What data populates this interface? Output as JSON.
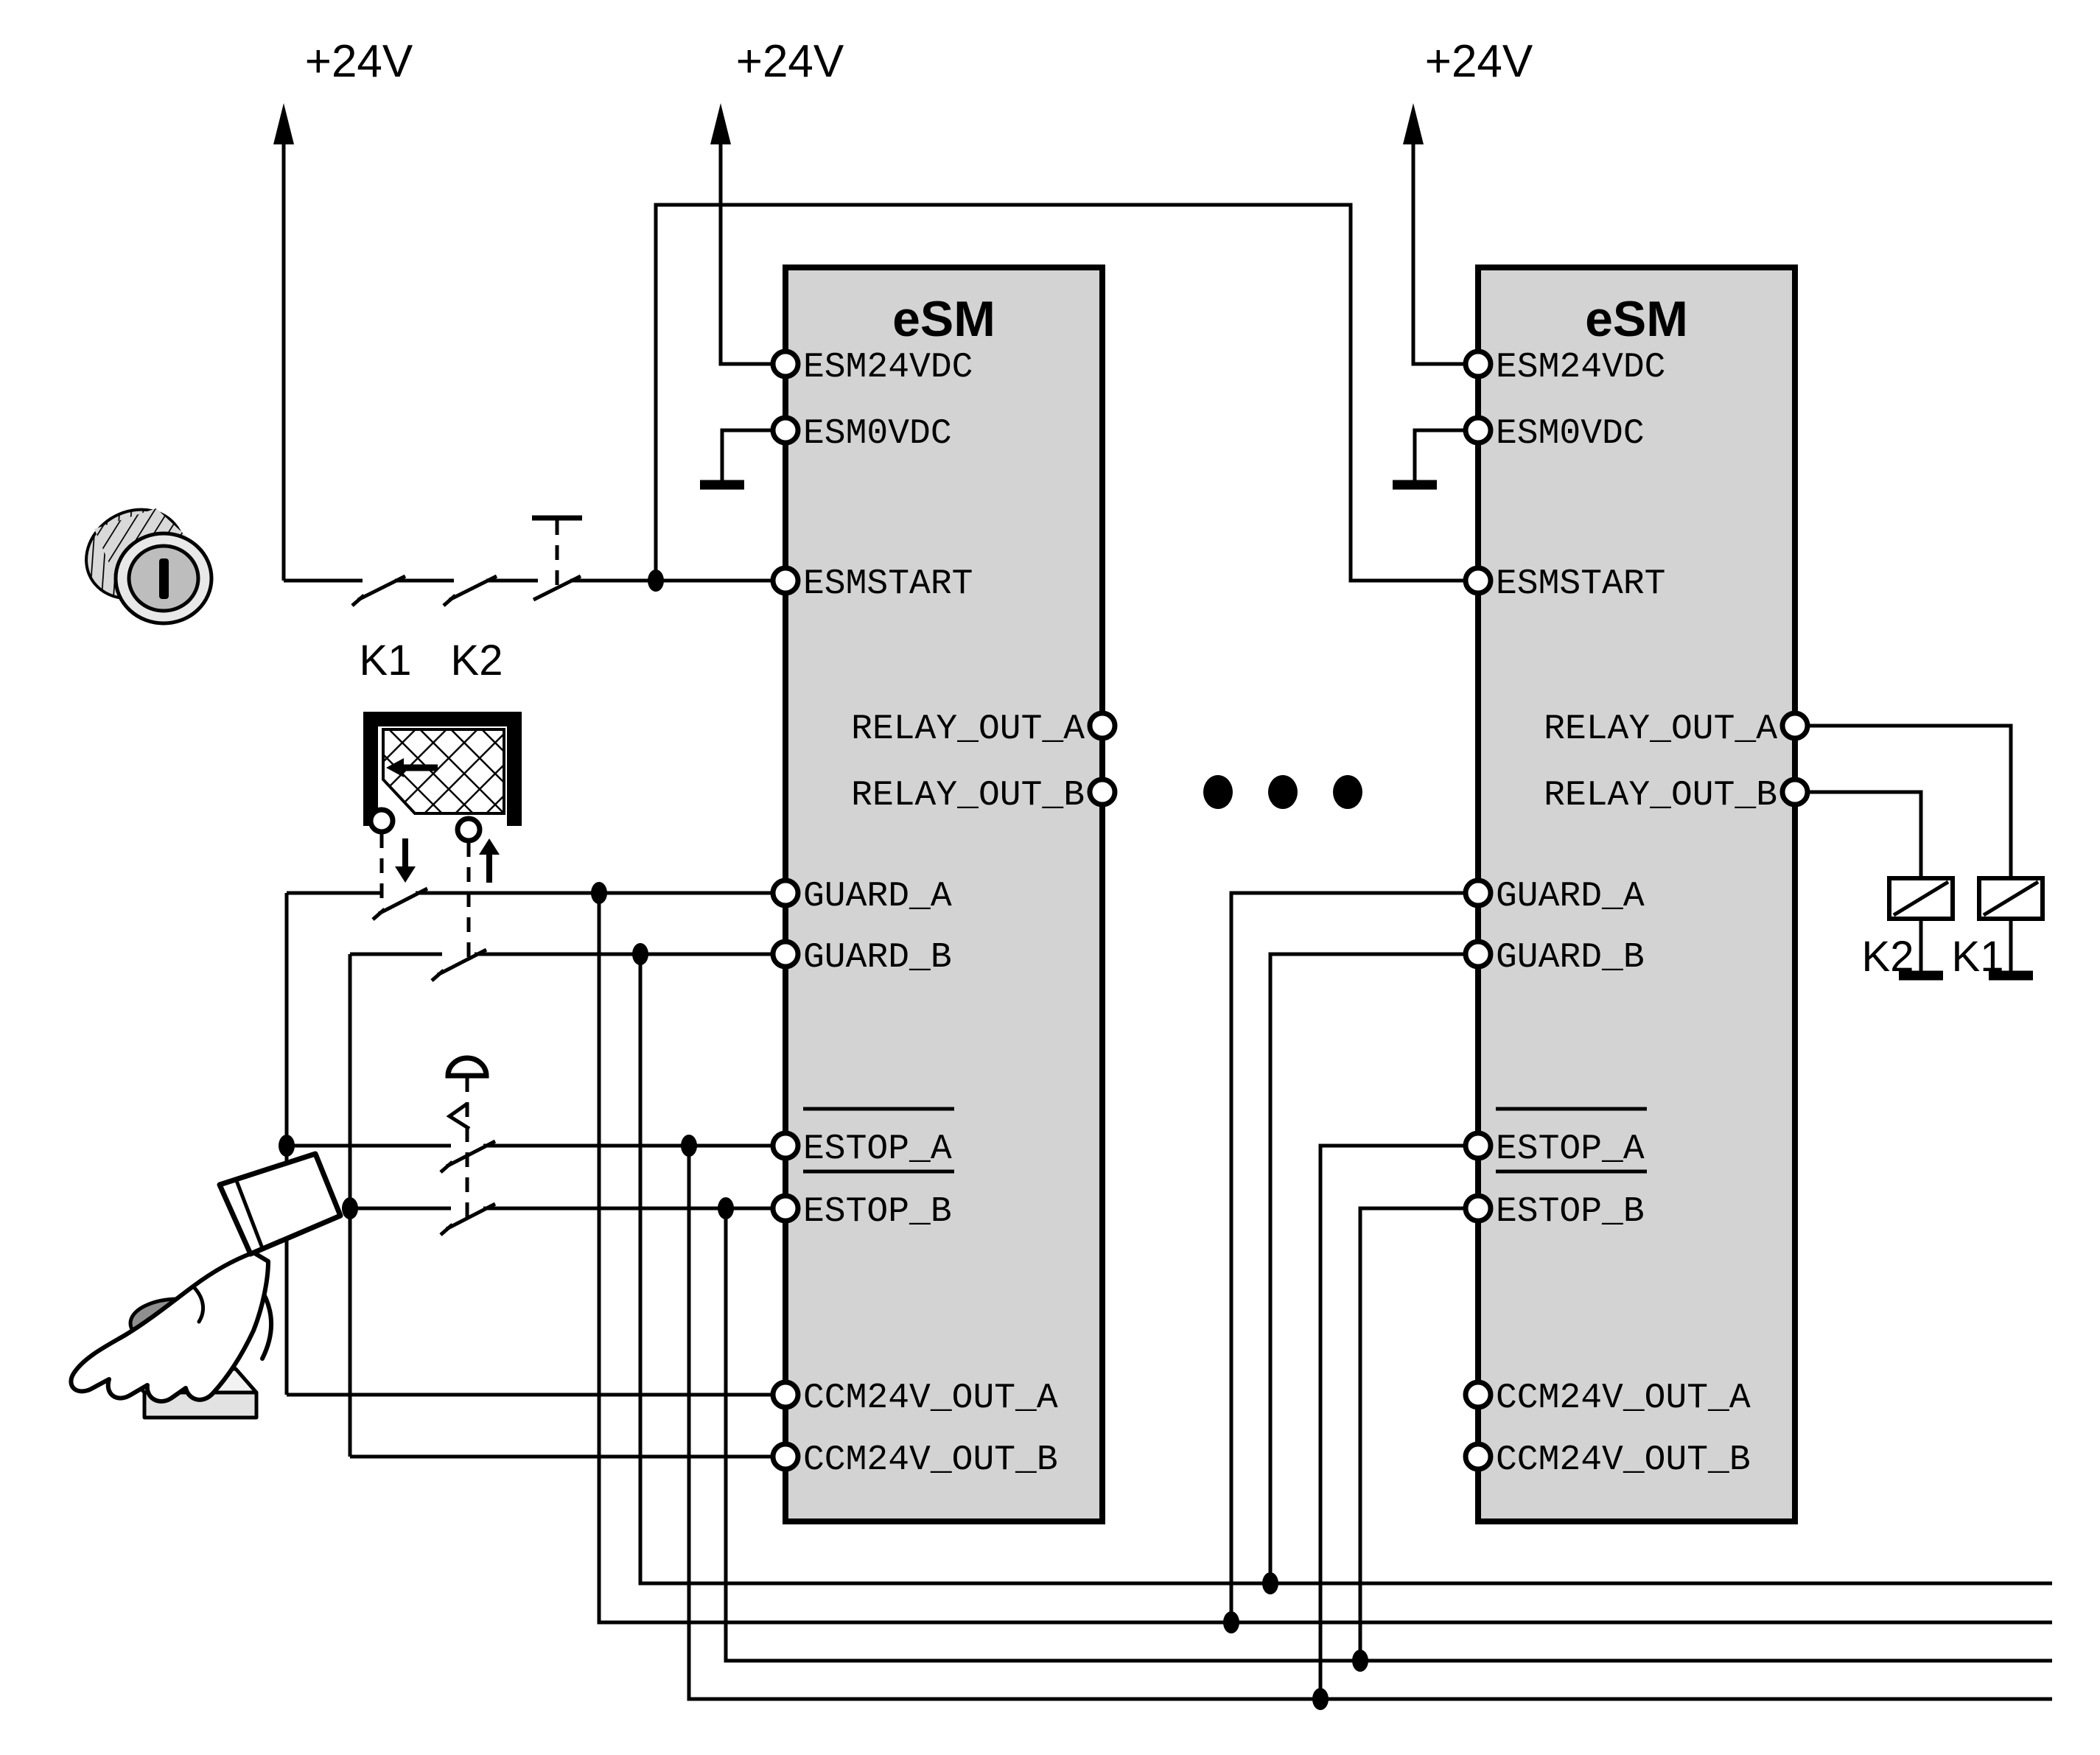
{
  "power": {
    "rail1": "+24V",
    "rail2": "+24V",
    "rail3": "+24V"
  },
  "modules": {
    "left": {
      "title": "eSM",
      "pins": {
        "esm24vdc": "ESM24VDC",
        "esm0vdc": "ESM0VDC",
        "esmstart": "ESMSTART",
        "relay_out_a": "RELAY_OUT_A",
        "relay_out_b": "RELAY_OUT_B",
        "guard_a": "GUARD_A",
        "guard_b": "GUARD_B",
        "estop_a": "ESTOP_A",
        "estop_b": "ESTOP_B",
        "ccm24v_out_a": "CCM24V_OUT_A",
        "ccm24v_out_b": "CCM24V_OUT_B"
      }
    },
    "right": {
      "title": "eSM",
      "pins": {
        "esm24vdc": "ESM24VDC",
        "esm0vdc": "ESM0VDC",
        "esmstart": "ESMSTART",
        "relay_out_a": "RELAY_OUT_A",
        "relay_out_b": "RELAY_OUT_B",
        "guard_a": "GUARD_A",
        "guard_b": "GUARD_B",
        "estop_a": "ESTOP_A",
        "estop_b": "ESTOP_B",
        "ccm24v_out_a": "CCM24V_OUT_A",
        "ccm24v_out_b": "CCM24V_OUT_B"
      }
    }
  },
  "start_branch": {
    "contact1": "K1",
    "contact2": "K2"
  },
  "relay_branch": {
    "coil_left": "K2",
    "coil_right": "K1"
  },
  "colors": {
    "background": "#ffffff",
    "line": "#000000",
    "module_fill": "#d3d3d3",
    "key_ring": "#e8e8e8",
    "key_face": "#bdbdbd",
    "key_body": "#d9d9d9",
    "estop_cap": "#8f8f8f",
    "estop_stem": "#b5b5b5",
    "estop_box_top": "#f2f2f2",
    "estop_box_front": "#e2e2e2"
  }
}
